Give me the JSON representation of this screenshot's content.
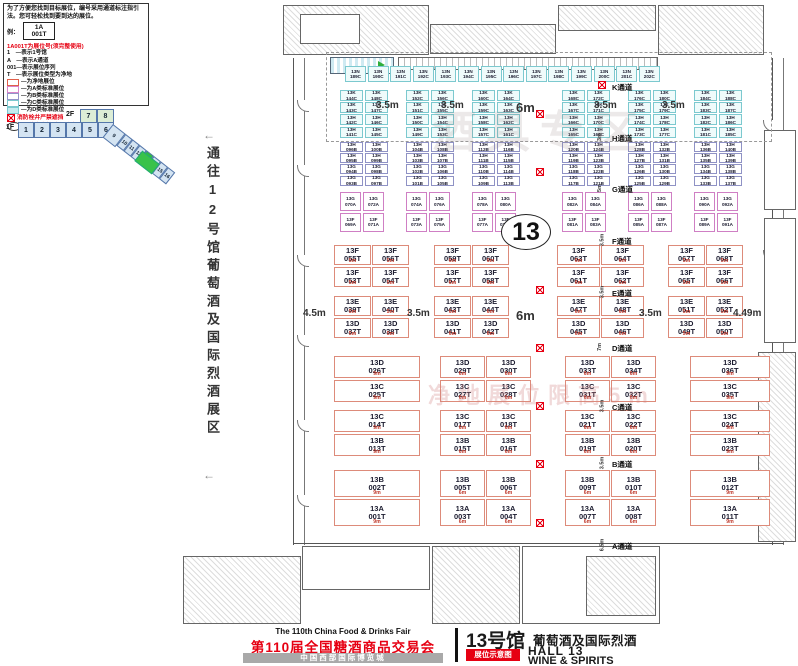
{
  "legend": {
    "intro": "为了方便您找到目标展位，编号采用通道标注指引法。您可轻松找到要到达的展位。",
    "example_label": "例：",
    "sample": {
      "line1": "1A",
      "line2": "001T"
    },
    "code_title": "1A001T为展位号(须完整使用)",
    "code_lines": [
      "1　—表示1号馆",
      "A　—表示A通道",
      "001—表示展位序列",
      "T　—表示展位类型为净地"
    ],
    "swatches": [
      {
        "type": "t",
        "label": "—为净地展位"
      },
      {
        "type": "a",
        "label": "—为A类标准展位"
      },
      {
        "type": "b",
        "label": "—为B类标准展位"
      },
      {
        "type": "c",
        "label": "—为C类标准展位"
      },
      {
        "type": "d",
        "label": "—为D类标准展位"
      }
    ],
    "fire_note": "消防栓井严禁遮挡",
    "column_note": "展位内立柱 直径均为1.5m"
  },
  "navigator": {
    "floor2_label": "2F",
    "floor2_cells": [
      "7",
      "8"
    ],
    "floor1_label": "1F",
    "floor1_cells": [
      "1",
      "2",
      "3",
      "4",
      "5",
      "6"
    ],
    "wing_cells": [
      "9",
      "10",
      "11",
      "12",
      "13",
      "14",
      "15",
      "16"
    ],
    "highlighted": "13"
  },
  "side_note": {
    "text": "通往12号馆葡萄酒及国际烈酒展区",
    "arrow": "←"
  },
  "watermarks": {
    "top": "酒具专区",
    "middle": "净地展位限高5m"
  },
  "hall_mark": "13",
  "aisles": [
    {
      "label": "K通道",
      "width": ""
    },
    {
      "label": "H通道",
      "width": "3m"
    },
    {
      "label": "G通道",
      "width": "5m"
    },
    {
      "label": "F通道",
      "width": "3.5m"
    },
    {
      "label": "E通道",
      "width": "3.5m"
    },
    {
      "label": "D通道",
      "width": "7m"
    },
    {
      "label": "C通道",
      "width": "3.5m"
    },
    {
      "label": "B通道",
      "width": "3.5m"
    },
    {
      "label": "A通道",
      "width": "6.5m"
    }
  ],
  "dim_labels": {
    "k_row": [
      "3.5m",
      "3.5m",
      "6m",
      "3.5m",
      "3.5m"
    ],
    "e_row": [
      "4.5m",
      "3.5m",
      "6m",
      "3.5m",
      "4.49m"
    ]
  },
  "blocks": {
    "top_strip": [
      "13N 189C",
      "13N 190C",
      "13N 191C",
      "13N 192C",
      "13N 193C",
      "13N 194C",
      "13N 195C",
      "13N 196C",
      "13N 197C",
      "13N 198C",
      "13N 199C",
      "13N 200C",
      "13N 201C",
      "13N 202C"
    ],
    "k_block": [
      [
        "13K 144C",
        "13K 148C",
        "13K 152C",
        "13K 156C",
        "13K 160C",
        "13K 164C",
        "13K 168C",
        "13K 172C",
        "13K 176C",
        "13K 180C",
        "13K 184C",
        "13K 188C"
      ],
      [
        "13K 143C",
        "13K 147C",
        "13K 151C",
        "13K 155C",
        "13K 159C",
        "13K 163C",
        "13K 167C",
        "13K 171C",
        "13K 175C",
        "13K 179C",
        "13K 183C",
        "13K 187C"
      ],
      [
        "13H 142C",
        "13H 146C",
        "13H 150C",
        "13H 154C",
        "13H 158C",
        "13H 162C",
        "13H 166C",
        "13H 170C",
        "13H 174C",
        "13H 178C",
        "13H 182C",
        "13H 186C"
      ],
      [
        "13H 141C",
        "13H 145C",
        "13H 149C",
        "13H 153C",
        "13H 157C",
        "13H 161C",
        "13H 165C",
        "13H 169C",
        "13H 173C",
        "13H 177C",
        "13H 181C",
        "13H 185C"
      ]
    ],
    "h_block": [
      [
        "13H 096B",
        "13H 100B",
        "13H 104B",
        "13H 108B",
        "13H 112B",
        "13H 116B",
        "13H 120B",
        "13H 124B",
        "13H 128B",
        "13H 132B",
        "13H 136B",
        "13H 140B"
      ],
      [
        "13H 095B",
        "13H 099B",
        "13H 103B",
        "13H 107B",
        "13H 111B",
        "13H 115B",
        "13H 119B",
        "13H 123B",
        "13H 127B",
        "13H 131B",
        "13H 135B",
        "13H 139B"
      ],
      [
        "13G 094B",
        "13G 098B",
        "13G 102B",
        "13G 106B",
        "13G 110B",
        "13G 114B",
        "13G 118B",
        "13G 122B",
        "13G 126B",
        "13G 130B",
        "13G 134B",
        "13G 138B"
      ],
      [
        "13G 093B",
        "13G 097B",
        "13G 101B",
        "13G 105B",
        "13G 109B",
        "13G 113B",
        "13G 117B",
        "13G 121B",
        "13G 125B",
        "13G 129B",
        "13G 133B",
        "13G 137B"
      ]
    ],
    "g_block": [
      [
        "13G 070A",
        "13G 072A",
        "13G 074A",
        "13G 076A",
        "13G 078A",
        "13G 080A",
        "13G 082A",
        "13G 084A",
        "13G 086A",
        "13G 088A",
        "13G 090A",
        "13G 092A"
      ],
      [
        "13F 069A",
        "13F 071A",
        "13F 073A",
        "13F 075A",
        "13F 077A",
        "13F 079A",
        "13F 081A",
        "13F 083A",
        "13F 085A",
        "13F 087A",
        "13F 089A",
        "13F 091A"
      ]
    ],
    "f_block": [
      [
        {
          "id": "13F 055T",
          "w": "5m"
        },
        {
          "id": "13F 056T",
          "w": "5m"
        },
        {
          "id": "13F 059T",
          "w": "6m"
        },
        {
          "id": "13F 060T",
          "w": "6m"
        },
        {
          "id": "13F 063T",
          "w": "6m"
        },
        {
          "id": "13F 064T",
          "w": "6m"
        },
        {
          "id": "13F 067T",
          "w": "5m"
        },
        {
          "id": "13F 068T",
          "w": "5m"
        }
      ],
      [
        {
          "id": "13F 053T",
          "w": "5m"
        },
        {
          "id": "13F 054T",
          "w": "5m"
        },
        {
          "id": "13F 057T",
          "w": "6m"
        },
        {
          "id": "13F 058T",
          "w": "6m"
        },
        {
          "id": "13F 061T",
          "w": "6m"
        },
        {
          "id": "13F 062T",
          "w": "6m"
        },
        {
          "id": "13F 065T",
          "w": "5m"
        },
        {
          "id": "13F 066T",
          "w": "5m"
        }
      ]
    ],
    "e_block": [
      [
        {
          "id": "13E 039T",
          "w": "5m"
        },
        {
          "id": "13E 040T",
          "w": "5m"
        },
        {
          "id": "13E 043T",
          "w": "6m"
        },
        {
          "id": "13E 044T",
          "w": "6m"
        },
        {
          "id": "13E 047T",
          "w": "6m"
        },
        {
          "id": "13E 048T",
          "w": "6m"
        },
        {
          "id": "13E 051T",
          "w": "5m"
        },
        {
          "id": "13E 052T",
          "w": "5m"
        }
      ],
      [
        {
          "id": "13D 037T",
          "w": "5m"
        },
        {
          "id": "13D 038T",
          "w": "5m"
        },
        {
          "id": "13D 041T",
          "w": "6m"
        },
        {
          "id": "13D 042T",
          "w": "6m"
        },
        {
          "id": "13D 045T",
          "w": "6m"
        },
        {
          "id": "13D 046T",
          "w": "6m"
        },
        {
          "id": "13D 049T",
          "w": "5m"
        },
        {
          "id": "13D 050T",
          "w": "5m"
        }
      ]
    ],
    "dc_block": [
      [
        {
          "id": "13D 026T",
          "w": "9m"
        },
        {
          "id": "13D 029T",
          "w": "6m"
        },
        {
          "id": "13D 030T",
          "w": "6m"
        },
        {
          "id": "13D 033T",
          "w": "6m"
        },
        {
          "id": "13D 034T",
          "w": "6m"
        },
        {
          "id": "13D 036T",
          "w": "9m"
        }
      ],
      [
        {
          "id": "13C 025T",
          "w": "9m"
        },
        {
          "id": "13C 027T",
          "w": "6m"
        },
        {
          "id": "13C 028T",
          "w": "6m"
        },
        {
          "id": "13C 031T",
          "w": "6m"
        },
        {
          "id": "13C 032T",
          "w": "6m"
        },
        {
          "id": "13C 035T",
          "w": "9m"
        }
      ]
    ],
    "cb_block": [
      [
        {
          "id": "13C 014T",
          "w": "9m"
        },
        {
          "id": "13C 017T",
          "w": "6m"
        },
        {
          "id": "13C 018T",
          "w": "6m"
        },
        {
          "id": "13C 021T",
          "w": "6m"
        },
        {
          "id": "13C 022T",
          "w": "6m"
        },
        {
          "id": "13C 024T",
          "w": "9m"
        }
      ],
      [
        {
          "id": "13B 013T",
          "w": "9m"
        },
        {
          "id": "13B 015T",
          "w": "6m"
        },
        {
          "id": "13B 016T",
          "w": "6m"
        },
        {
          "id": "13B 019T",
          "w": "6m"
        },
        {
          "id": "13B 020T",
          "w": "6m"
        },
        {
          "id": "13B 023T",
          "w": "9m"
        }
      ]
    ],
    "ba_block": [
      [
        {
          "id": "13B 002T",
          "w": "9m"
        },
        {
          "id": "13B 005T",
          "w": "6m"
        },
        {
          "id": "13B 006T",
          "w": "6m"
        },
        {
          "id": "13B 009T",
          "w": "6m"
        },
        {
          "id": "13B 010T",
          "w": "6m"
        },
        {
          "id": "13B 012T",
          "w": "9m"
        }
      ],
      [
        {
          "id": "13A 001T",
          "w": "9m"
        },
        {
          "id": "13A 003T",
          "w": "6m"
        },
        {
          "id": "13A 004T",
          "w": "6m"
        },
        {
          "id": "13A 007T",
          "w": "6m"
        },
        {
          "id": "13A 008T",
          "w": "6m"
        },
        {
          "id": "13A 011T",
          "w": "9m"
        }
      ]
    ]
  },
  "footer": {
    "fair_en": "The 110th China Food & Drinks Fair",
    "fair_cn": "第110届全国糖酒商品交易会",
    "venue": "中国西部国际博览城",
    "hall_cn": "13号馆",
    "category_cn": "葡萄酒及国际烈酒",
    "badge": "展位示意图",
    "hall_en": "HALL 13",
    "category_en": "WINE & SPIRITS"
  }
}
